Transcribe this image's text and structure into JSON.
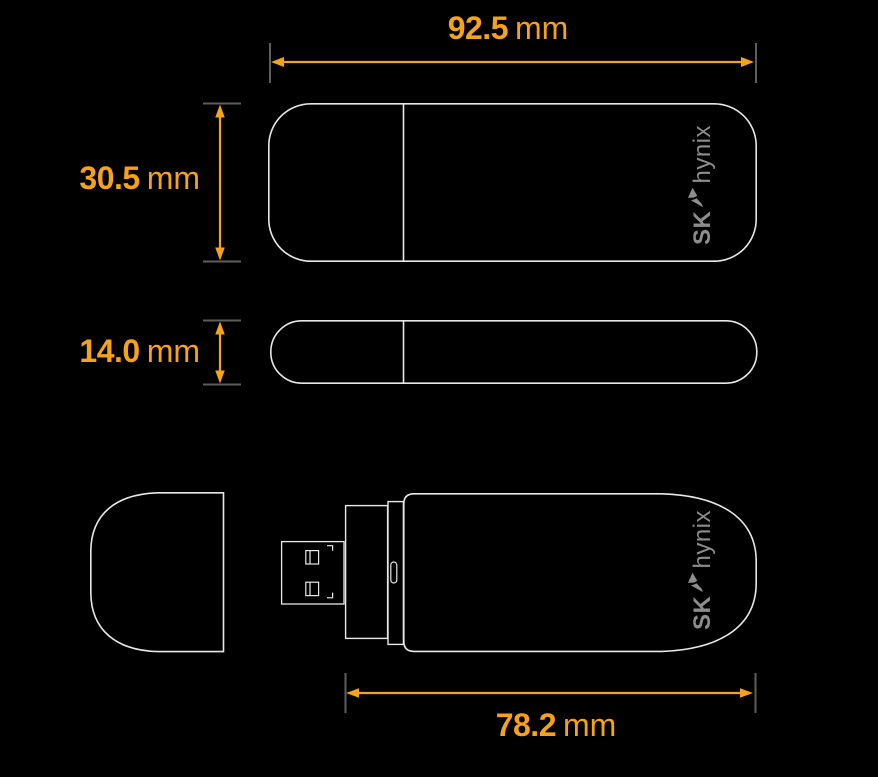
{
  "colors": {
    "accent_orange": "#f5a21c",
    "outline_white": "#e8e8e8",
    "tick_gray": "#5e5e5e",
    "logo_gray": "#8d8d8d",
    "background": "#000000"
  },
  "dimensions": {
    "width": {
      "value": "92.5",
      "unit": "mm"
    },
    "height": {
      "value": "30.5",
      "unit": "mm"
    },
    "thickness": {
      "value": "14.0",
      "unit": "mm"
    },
    "body_length": {
      "value": "78.2",
      "unit": "mm"
    }
  },
  "branding": {
    "sk": "SK",
    "hynix": "hynix",
    "wing_icon": "sk-wing-icon"
  }
}
